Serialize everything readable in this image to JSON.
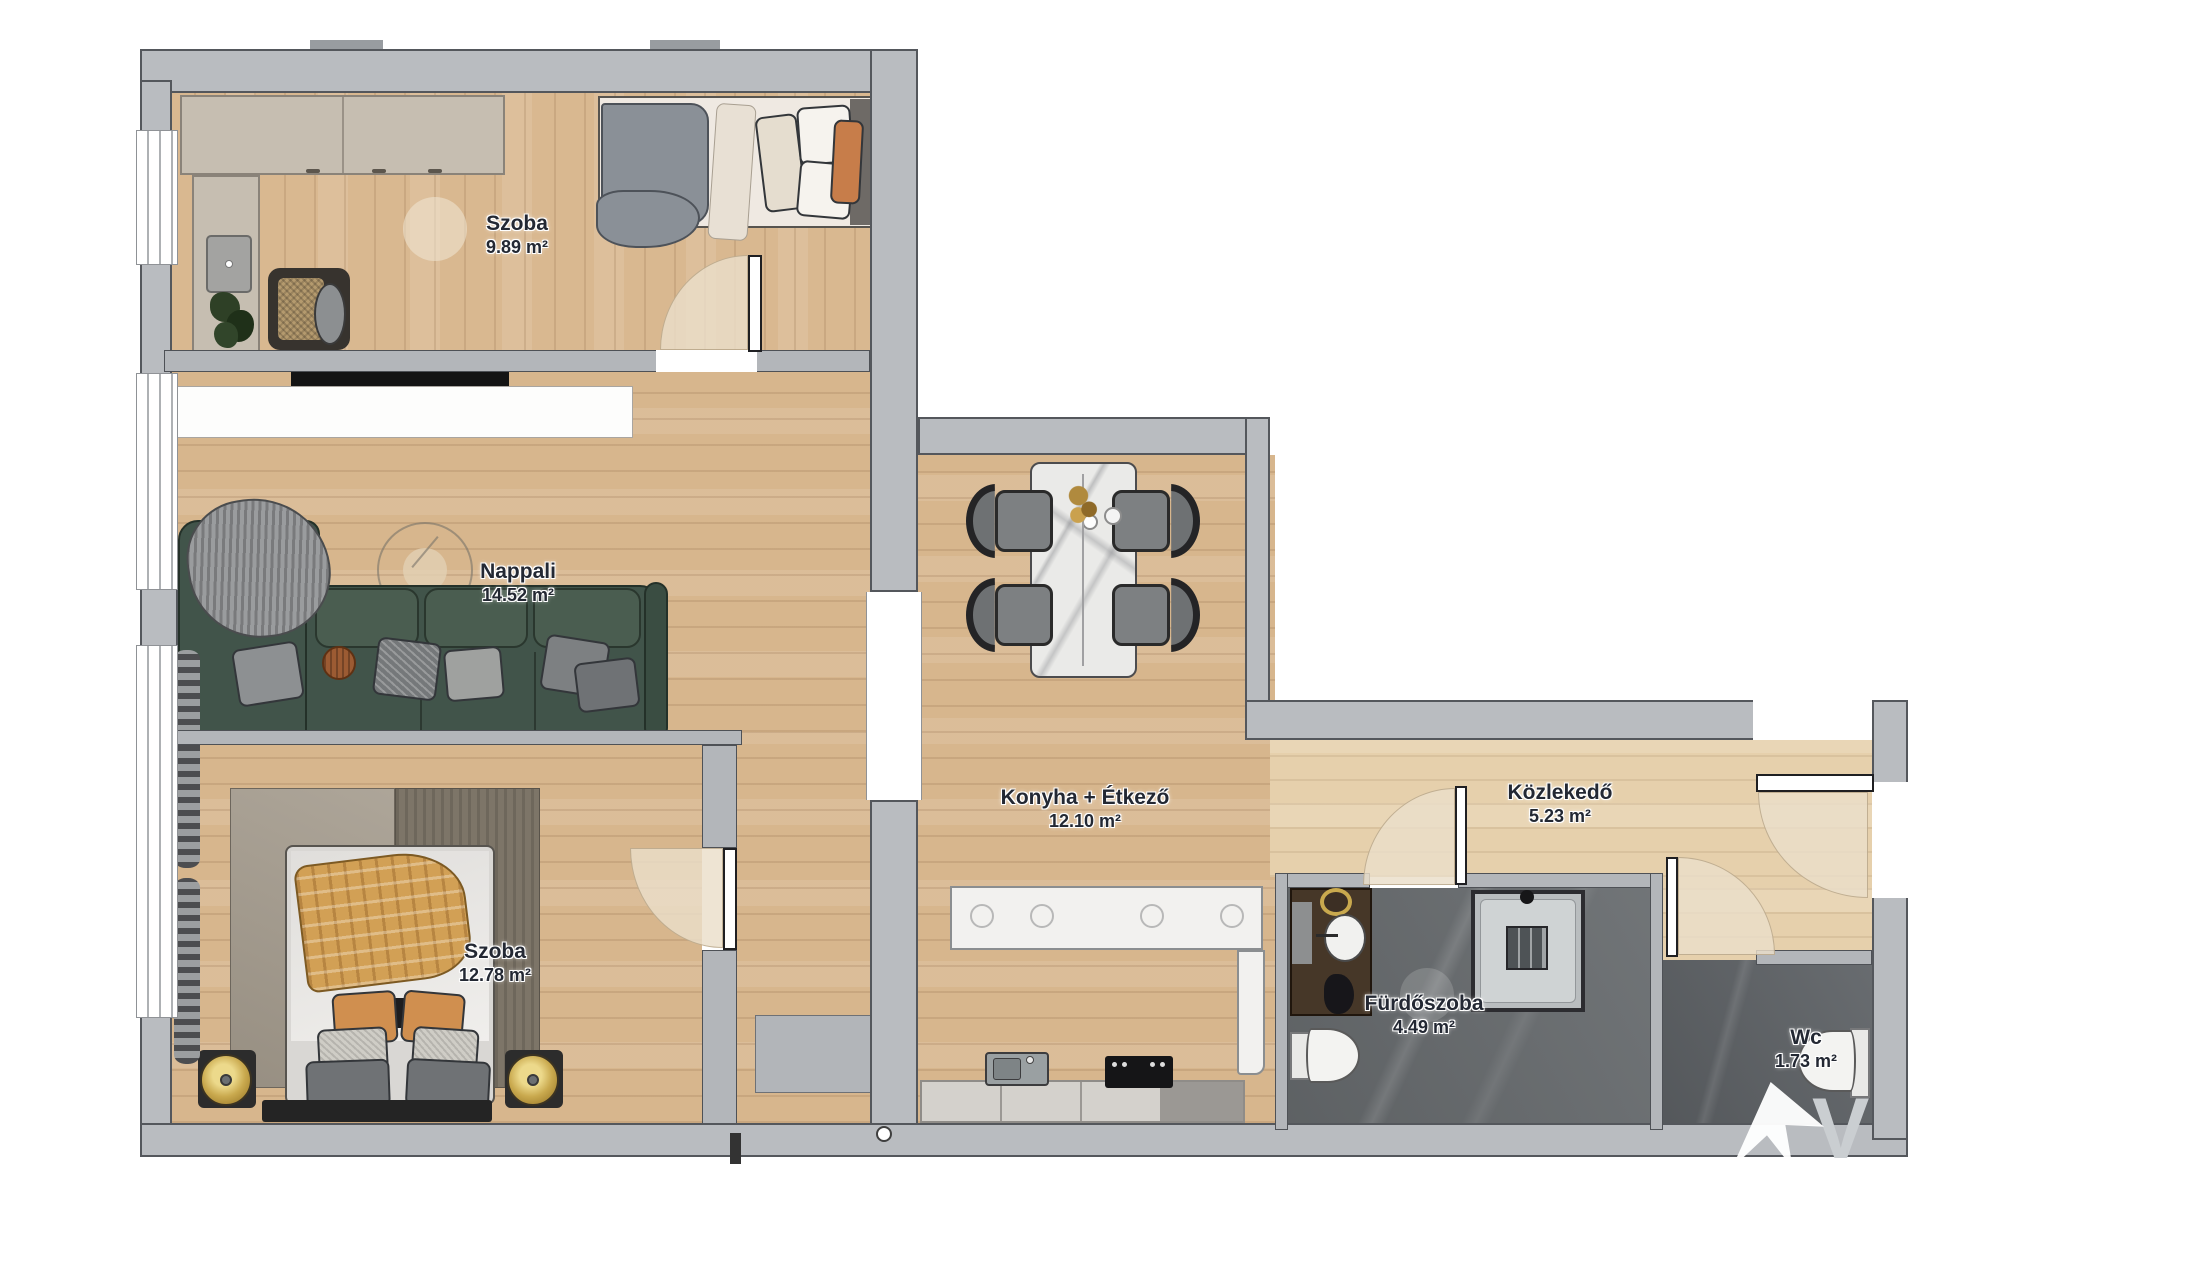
{
  "plan": {
    "rooms": [
      {
        "id": "szoba1",
        "name": "Szoba",
        "area": "9.89 m²"
      },
      {
        "id": "nappali",
        "name": "Nappali",
        "area": "14.52 m²"
      },
      {
        "id": "szoba2",
        "name": "Szoba",
        "area": "12.78 m²"
      },
      {
        "id": "konyha",
        "name": "Konyha + Étkező",
        "area": "12.10 m²"
      },
      {
        "id": "kozlekedo",
        "name": "Közlekedő",
        "area": "5.23 m²"
      },
      {
        "id": "furdoszoba",
        "name": "Fürdőszoba",
        "area": "4.49 m²"
      },
      {
        "id": "wc",
        "name": "Wc",
        "area": "1.73 m²"
      }
    ],
    "watermark": {
      "letter": "V"
    },
    "colors": {
      "wall": "#b9bcc0",
      "wall_outline": "#54575c",
      "wood": "#d7b68d",
      "wood_light": "#e6d0ac",
      "tile_dark": "#686c6f",
      "sofa_green": "#41544a",
      "accent_orange": "#c77d4a",
      "label_text": "#232833"
    }
  }
}
